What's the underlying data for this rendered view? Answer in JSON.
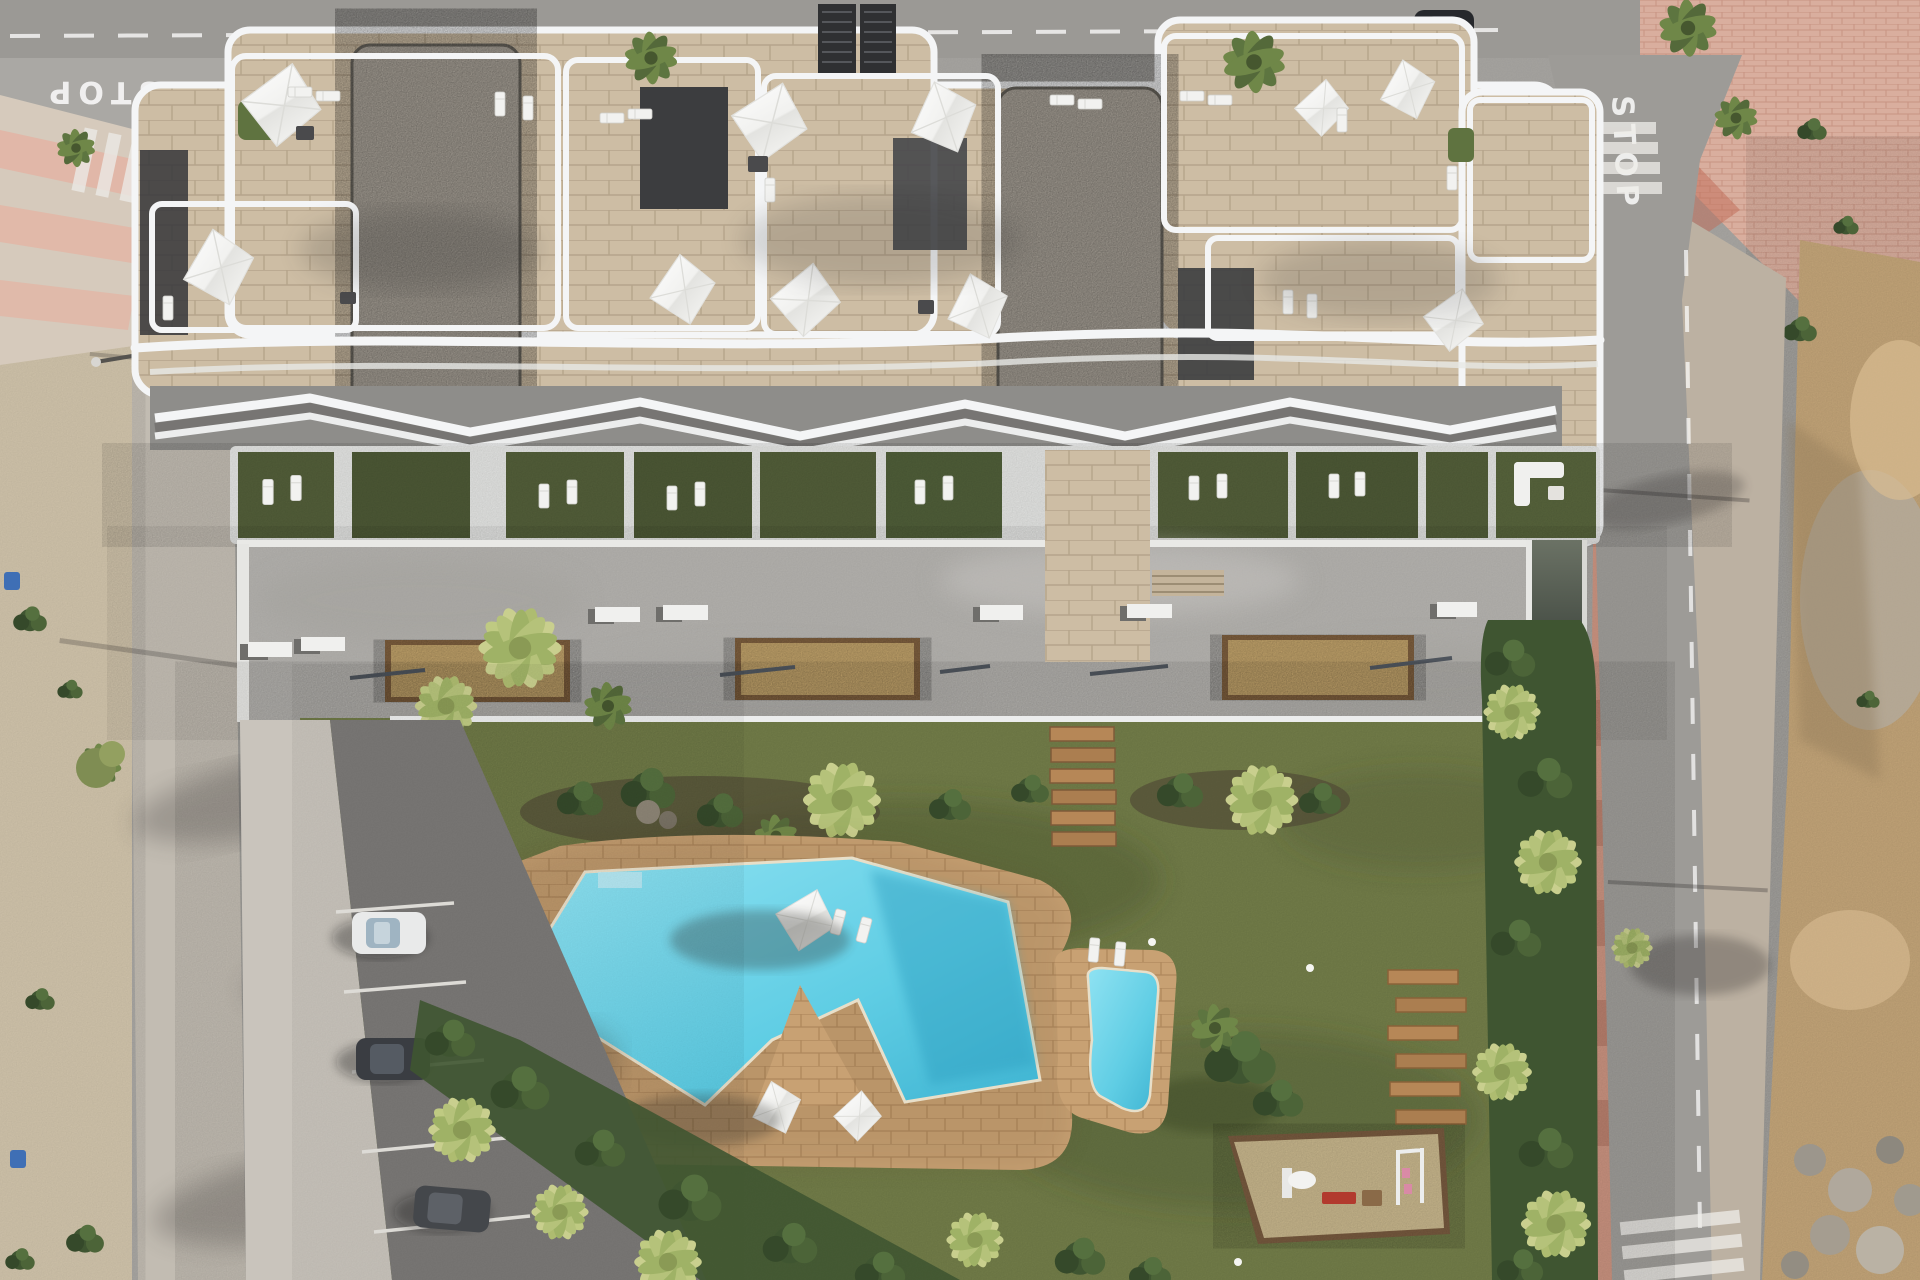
{
  "title": "Aerial 3D render of apartment complex with roof terraces, plaza, garden and pools",
  "road_markings": {
    "stop_left": "STOP",
    "stop_right": "STOP"
  },
  "palette": {
    "road": "#a8a6a2",
    "road_dark": "#969491",
    "asphalt": "#7b7977",
    "sidewalk": "#c6c0b6",
    "sand_left": "#d3c6ad",
    "pink_walk": "#d9ae9e",
    "pink_lane": "#c9927f",
    "dirt": "#c7a87b",
    "plaza": "#b5b3af",
    "stone": "#cdbda4",
    "gravel": "#b2aba0",
    "roof_dark": "#3c3d3f",
    "white_trim": "#f4f5f6",
    "garden_green": "#55613b",
    "lawn": "#76814b",
    "hedge": "#3f5531",
    "palm_light": "#c9cf8e",
    "palm_mid": "#8ca55e",
    "pool_water": "#5fcde4",
    "pool_deck": "#c8a173",
    "planter_sand": "#cfae72",
    "planter_rim": "#8a6844",
    "wood": "#b68757",
    "sail": "#fbfbfb",
    "car_dark": "#3a3d42",
    "car_white": "#e9eaea",
    "red_equipment": "#b23a2e"
  },
  "scene": {
    "building": {
      "sun_sails": 10,
      "gravel_roof_patches": 2,
      "stair_cores": 2,
      "roof_lounger_pairs": 8
    },
    "ground_floor": {
      "private_gardens": 10,
      "pergola_band": true
    },
    "plaza": {
      "planters": 3,
      "benches": 7,
      "bike_racks": 4
    },
    "garden": {
      "pools": 2,
      "deck_sun_sails": 3,
      "wooden_loungers": 6,
      "stepping_planks": 6,
      "playground": true
    },
    "parking": {
      "stalls": 5,
      "parked_cars": 3
    },
    "streets": {
      "crosswalks": 4,
      "car_on_ramp": 1,
      "parked_car_top": 1,
      "stop_markings": 2
    }
  }
}
